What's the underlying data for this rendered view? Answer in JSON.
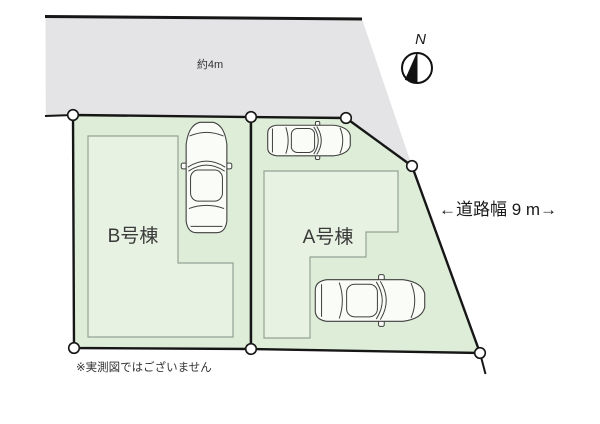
{
  "diagram": {
    "road": {
      "width_label": "約4m"
    },
    "road_side_note": "←道路幅 9 m→",
    "compass": {
      "north_label": "N"
    },
    "lots": [
      {
        "id": "B",
        "label": "B号棟"
      },
      {
        "id": "A",
        "label": "A号棟"
      }
    ],
    "disclaimer": "※実測図ではございません"
  },
  "colors": {
    "background": "#ffffff",
    "road_fill": "#e4e4e6",
    "lot_fill": "#deedd8",
    "building_fill": "#e8f2e2",
    "building_stroke": "#94a394",
    "boundary_line": "#161616",
    "car_outline": "#3f3f3f",
    "text": "#333333"
  }
}
